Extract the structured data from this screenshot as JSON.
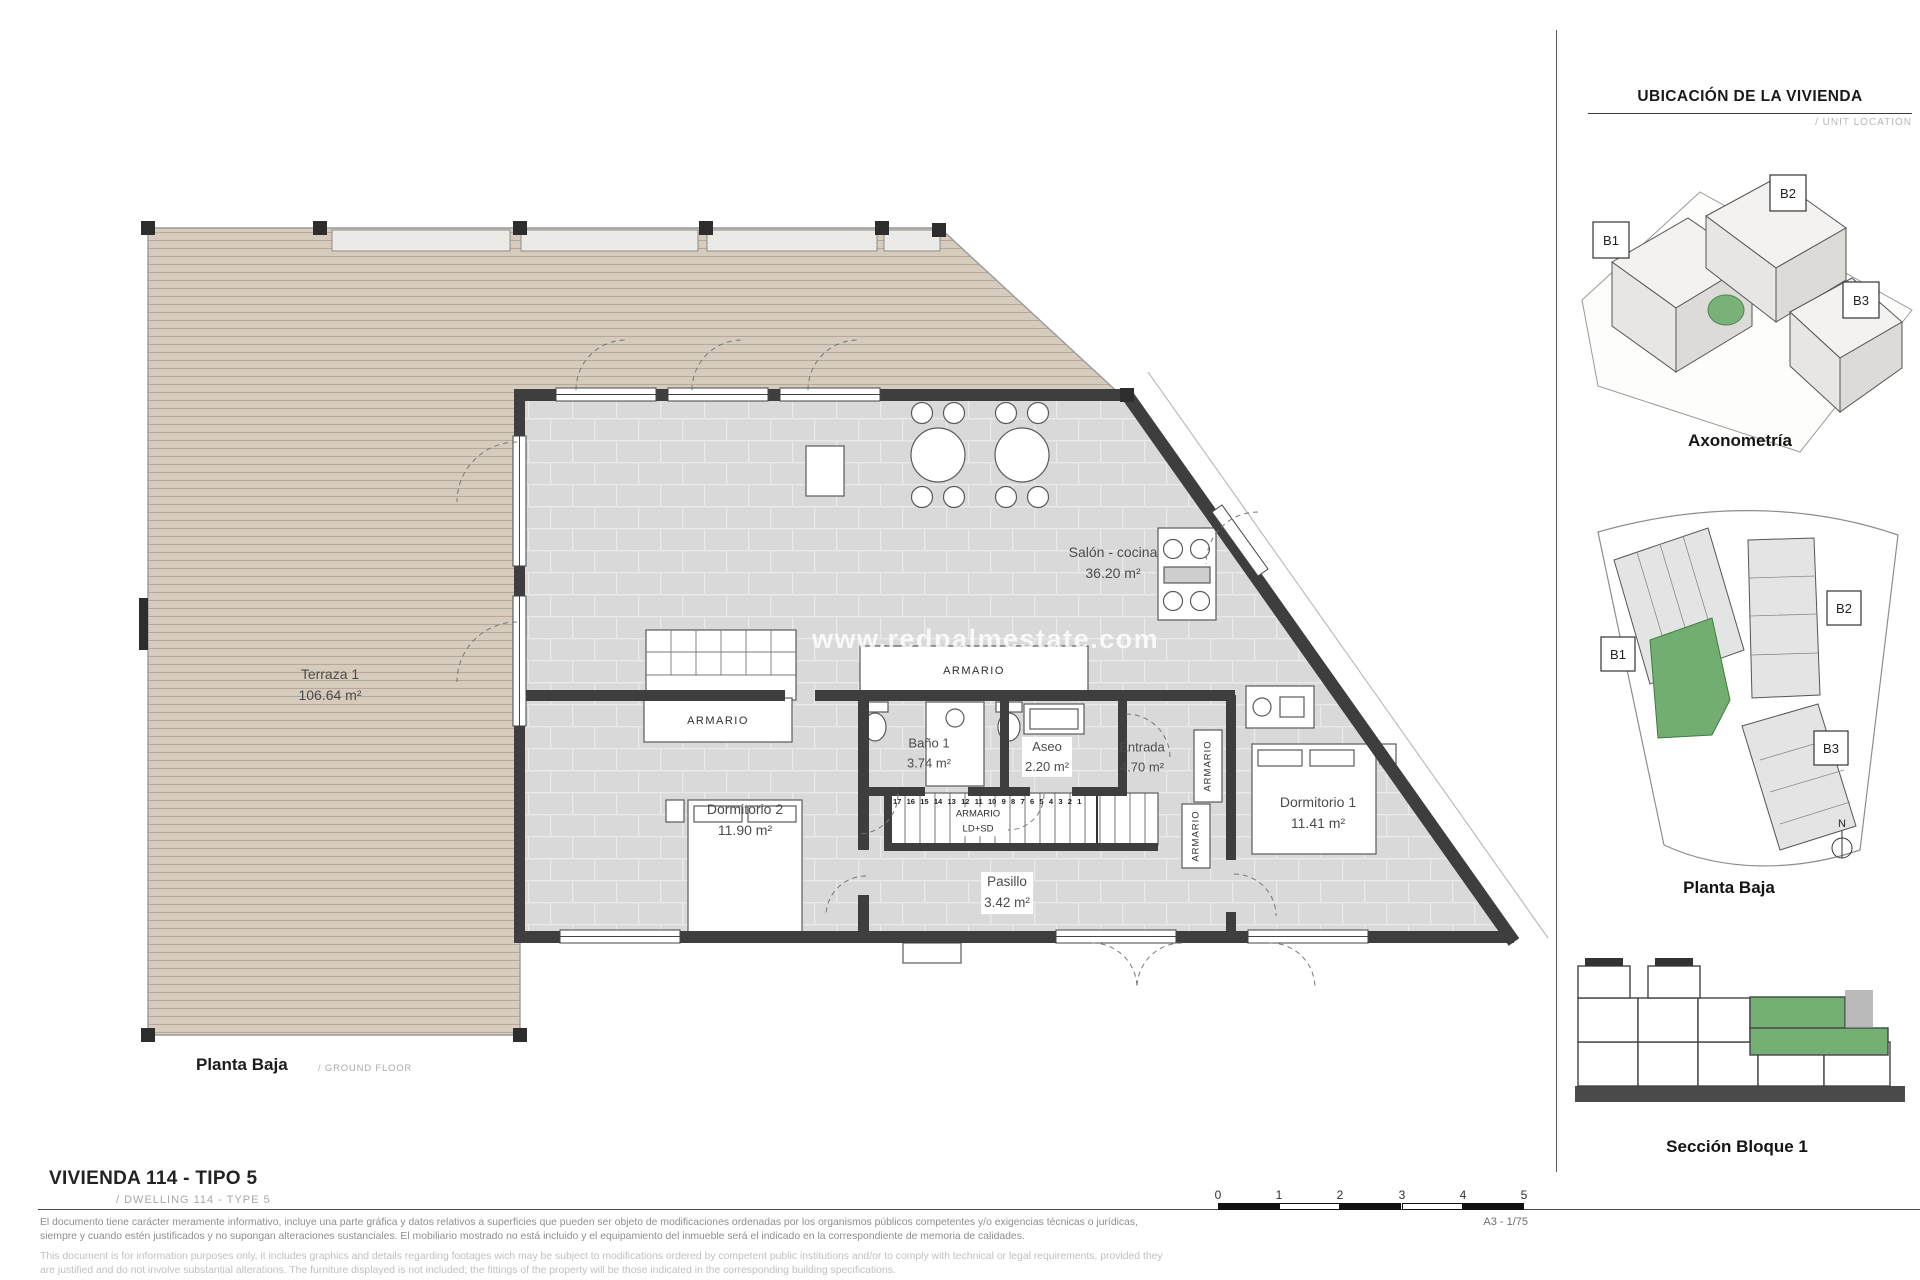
{
  "sidebar": {
    "title": "UBICACIÓN DE LA VIVIENDA",
    "subtitle": "/ UNIT LOCATION",
    "blocks": {
      "b1": "B1",
      "b2": "B2",
      "b3": "B3"
    },
    "north": "N",
    "captions": {
      "axonometria": "Axonometría",
      "planta_baja": "Planta Baja",
      "seccion": "Sección Bloque 1"
    }
  },
  "plan": {
    "watermark": "www.redpalmestate.com",
    "rooms": {
      "terraza": {
        "name": "Terraza 1",
        "area": "106.64 m²"
      },
      "salon": {
        "name": "Salón - cocina",
        "area": "36.20 m²"
      },
      "banyo": {
        "name": "Baño 1",
        "area": "3.74 m²"
      },
      "aseo": {
        "name": "Aseo",
        "area": "2.20 m²"
      },
      "entrada": {
        "name": "Entrada",
        "area": "4.70 m²"
      },
      "dorm2": {
        "name": "Dormitorio 2",
        "area": "11.90 m²"
      },
      "dorm1": {
        "name": "Dormitorio 1",
        "area": "11.41 m²"
      },
      "pasillo": {
        "name": "Pasillo",
        "area": "3.42 m²"
      }
    },
    "labels": {
      "armario": "ARMARIO",
      "armario_ld_sd": "LD+SD"
    },
    "stairs": "17 16 15 14 13 12 11 10 9 8 7 6 5 4 3 2 1",
    "caption": "Planta Baja",
    "caption_sub": "/ GROUND FLOOR"
  },
  "footer": {
    "title": "VIVIENDA 114 - TIPO 5",
    "subtitle": "/ DWELLING 114 - TYPE 5",
    "disclaimer_es": "El documento tiene carácter meramente informativo, incluye una parte gráfica y datos relativos a superficies que pueden ser objeto de modificaciones ordenadas por los organismos públicos competentes y/o exigencias técnicas o jurídicas, siempre y cuando estén justificados y no supongan alteraciones sustanciales. El mobiliario mostrado no está incluido y el equipamiento del inmueble será el indicado en la correspondiente de memoria de calidades.",
    "disclaimer_en": "This document is for information purposes only, it includes graphics and details regarding footages wich may be subject to modifications ordered by competent public institutions and/or to comply with technical or legal requirements, provided they are justified and do not involve substantial alterations. The furniture displayed is not included; the fittings of the property will be those indicated in the corresponding building specifications.",
    "scale_ticks": [
      "0",
      "1",
      "2",
      "3",
      "4",
      "5"
    ],
    "sheet_ref": "A3 - 1/75"
  },
  "colors": {
    "highlight_green": "#6fae6f",
    "deck": "#d6ccbe",
    "tile": "#d9d9d9",
    "wall": "#3e3e3e"
  }
}
